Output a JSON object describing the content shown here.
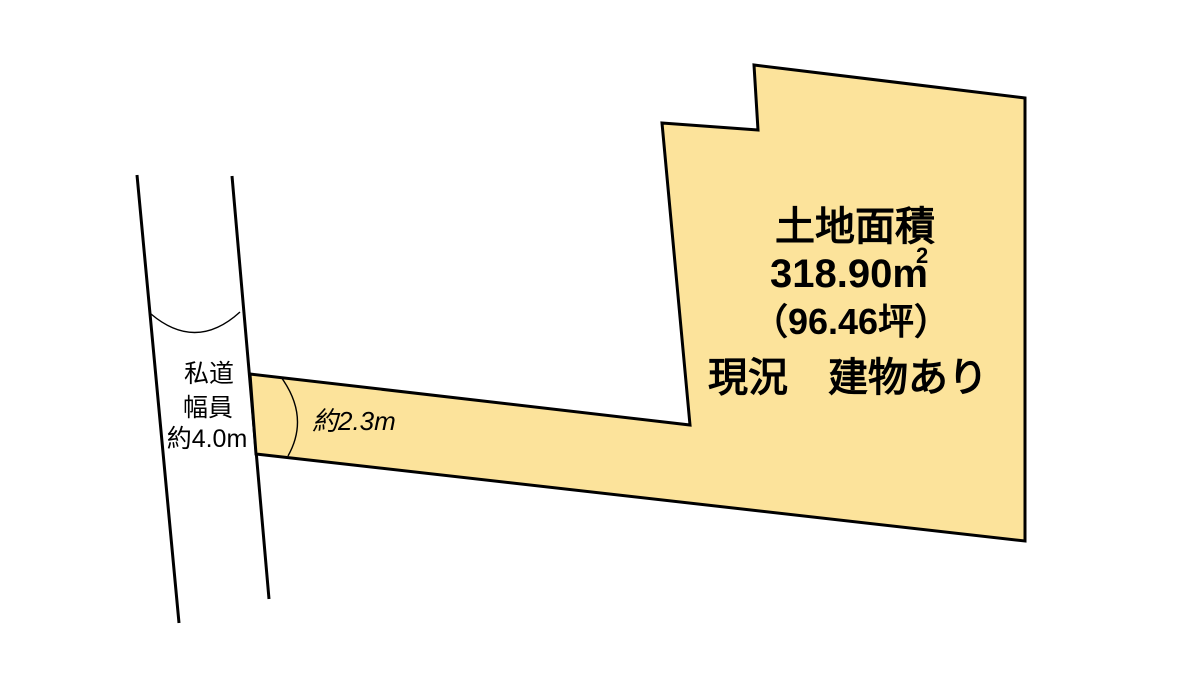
{
  "diagram": {
    "type": "land-plot-diagram",
    "colors": {
      "background": "#ffffff",
      "parcel_fill": "#fce39b",
      "outline": "#000000"
    },
    "parcel": {
      "title": "土地面積",
      "area_main": "318.90m",
      "area_superscript": "2",
      "area_tsubo": "（96.46坪）",
      "status": "現況　建物あり"
    },
    "road": {
      "name": "私道",
      "width_caption": "幅員",
      "width_value": "約4.0m"
    },
    "approach": {
      "width_label": "約2.3m"
    }
  }
}
